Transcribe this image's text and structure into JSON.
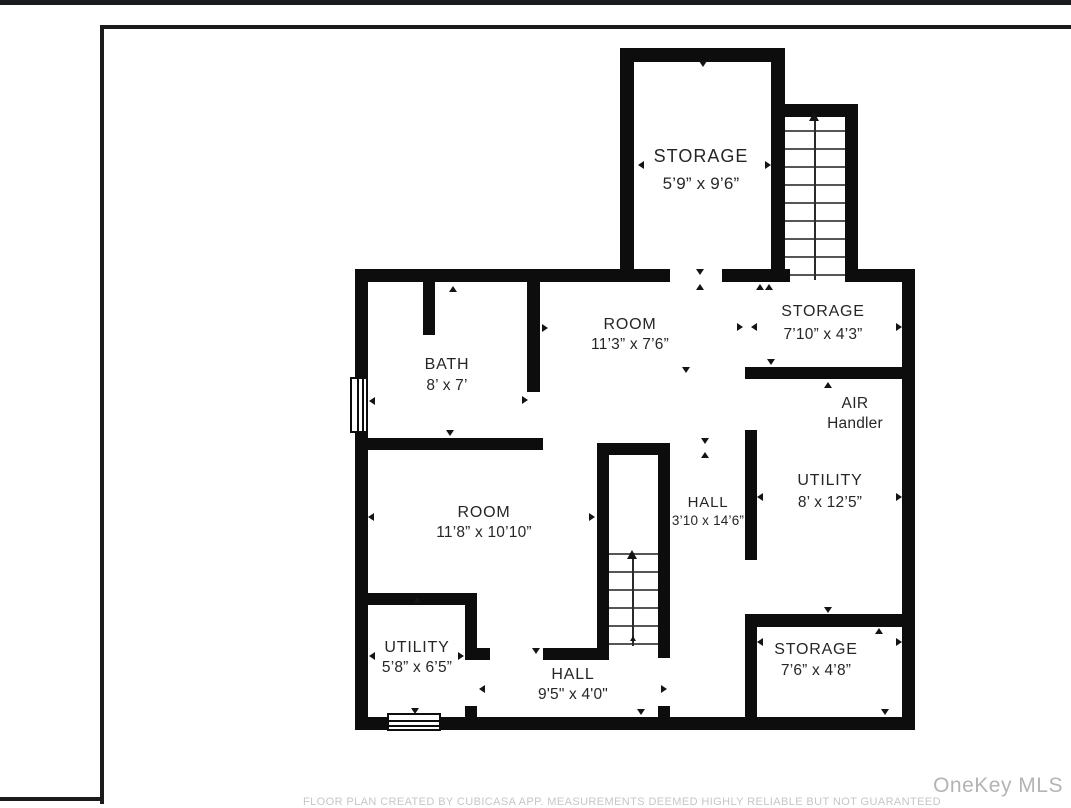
{
  "page": {
    "footer_disclaimer": "FLOOR PLAN CREATED BY CUBICASA APP. MEASUREMENTS DEEMED HIGHLY RELIABLE BUT NOT GUARANTEED",
    "watermark": "OneKey MLS"
  },
  "floor_plan": {
    "rooms": [
      {
        "name": "STORAGE",
        "dims": "5’9” x 9’6”"
      },
      {
        "name": "ROOM",
        "dims": "11’3” x 7’6”"
      },
      {
        "name": "STORAGE",
        "dims": "7’10” x 4’3”"
      },
      {
        "name": "BATH",
        "dims": "8’ x 7’"
      },
      {
        "name": "AIR",
        "dims": "Handler"
      },
      {
        "name": "UTILITY",
        "dims": "8’ x 12’5”"
      },
      {
        "name": "ROOM",
        "dims": "11’8” x 10’10”"
      },
      {
        "name": "HALL",
        "dims": "3’10 x 14’6”"
      },
      {
        "name": "UTILITY",
        "dims": "5’8” x 6’5”"
      },
      {
        "name": "HALL",
        "dims": "9'5\" x 4'0\""
      },
      {
        "name": "STORAGE",
        "dims": "7’6” x 4’8”"
      }
    ],
    "stairs": [
      {
        "label": "stairs-upper-right",
        "direction": "up"
      },
      {
        "label": "stairs-middle",
        "direction": "up"
      }
    ],
    "colors": {
      "wall": "#0d0d0d",
      "label": "#262626",
      "tread": "#565656"
    }
  }
}
